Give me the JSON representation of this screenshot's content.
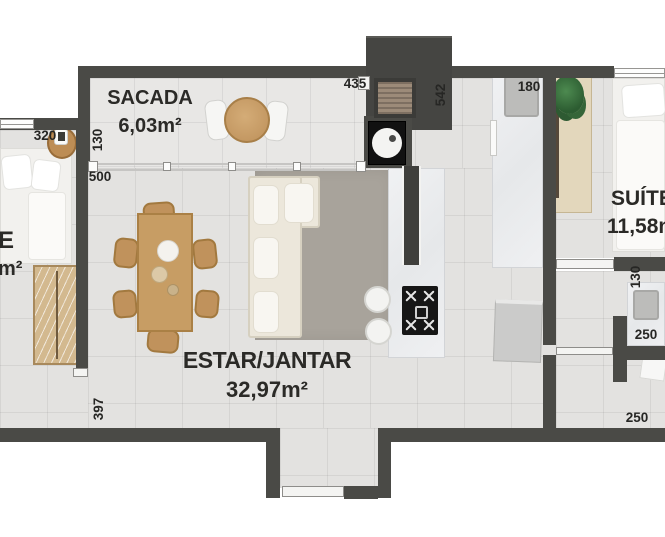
{
  "rooms": {
    "sacada": {
      "name": "SACADA",
      "area": "6,03m²"
    },
    "estar_jantar": {
      "name": "ESTAR/JANTAR",
      "area": "32,97m²"
    },
    "suite": {
      "name": "SUÍTE",
      "area": "11,58m²"
    },
    "left_room_partial": {
      "name_fragment": "E",
      "area_fragment": "m²"
    }
  },
  "dims": {
    "d320": "320",
    "d130_left": "130",
    "d500": "500",
    "d435": "435",
    "d542": "542",
    "d180": "180",
    "d130_right": "130",
    "d250_mid": "250",
    "d250_bottom": "250",
    "d397": "397"
  },
  "furniture": [
    "double-bed",
    "nightstand-with-lamp",
    "wardrobe",
    "balcony-round-table",
    "balcony-chairs",
    "l-shaped-sofa",
    "area-rug",
    "dining-table-six-chairs",
    "kitchen-island-with-cooktop",
    "bar-stools",
    "kitchen-counter-with-sink",
    "refrigerator",
    "washing-machine",
    "utility-shaft-vent",
    "suite-bed",
    "desk-with-plant",
    "bathroom-counter-sink",
    "bathroom-fixture"
  ],
  "colors": {
    "wall": "#4a4a46",
    "floor": "#e3e2e0",
    "balcony_floor": "#e8e7e5",
    "wood": "#c79d64",
    "rug": "#a8a39b",
    "text": "#2b2a27"
  }
}
